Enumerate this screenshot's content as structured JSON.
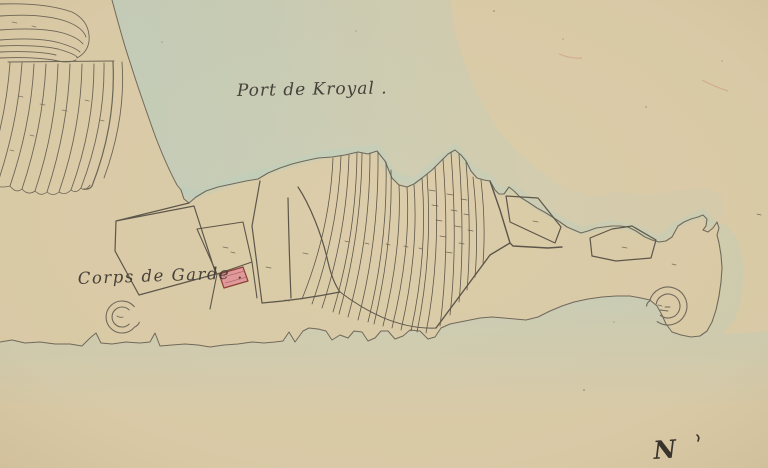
{
  "map": {
    "labels": {
      "port": "Port de Kroyal .",
      "guard": "Corps de Garde .",
      "north": "N"
    },
    "colors": {
      "paper": "#dccdaa",
      "water_wash": "#b7cfc5",
      "parcel_ink": "#5c564a",
      "coast_ink": "#6f695c",
      "building_fill": "#e29a9d",
      "building_stroke": "#8e3e35",
      "label_ink": "#45403a"
    }
  }
}
